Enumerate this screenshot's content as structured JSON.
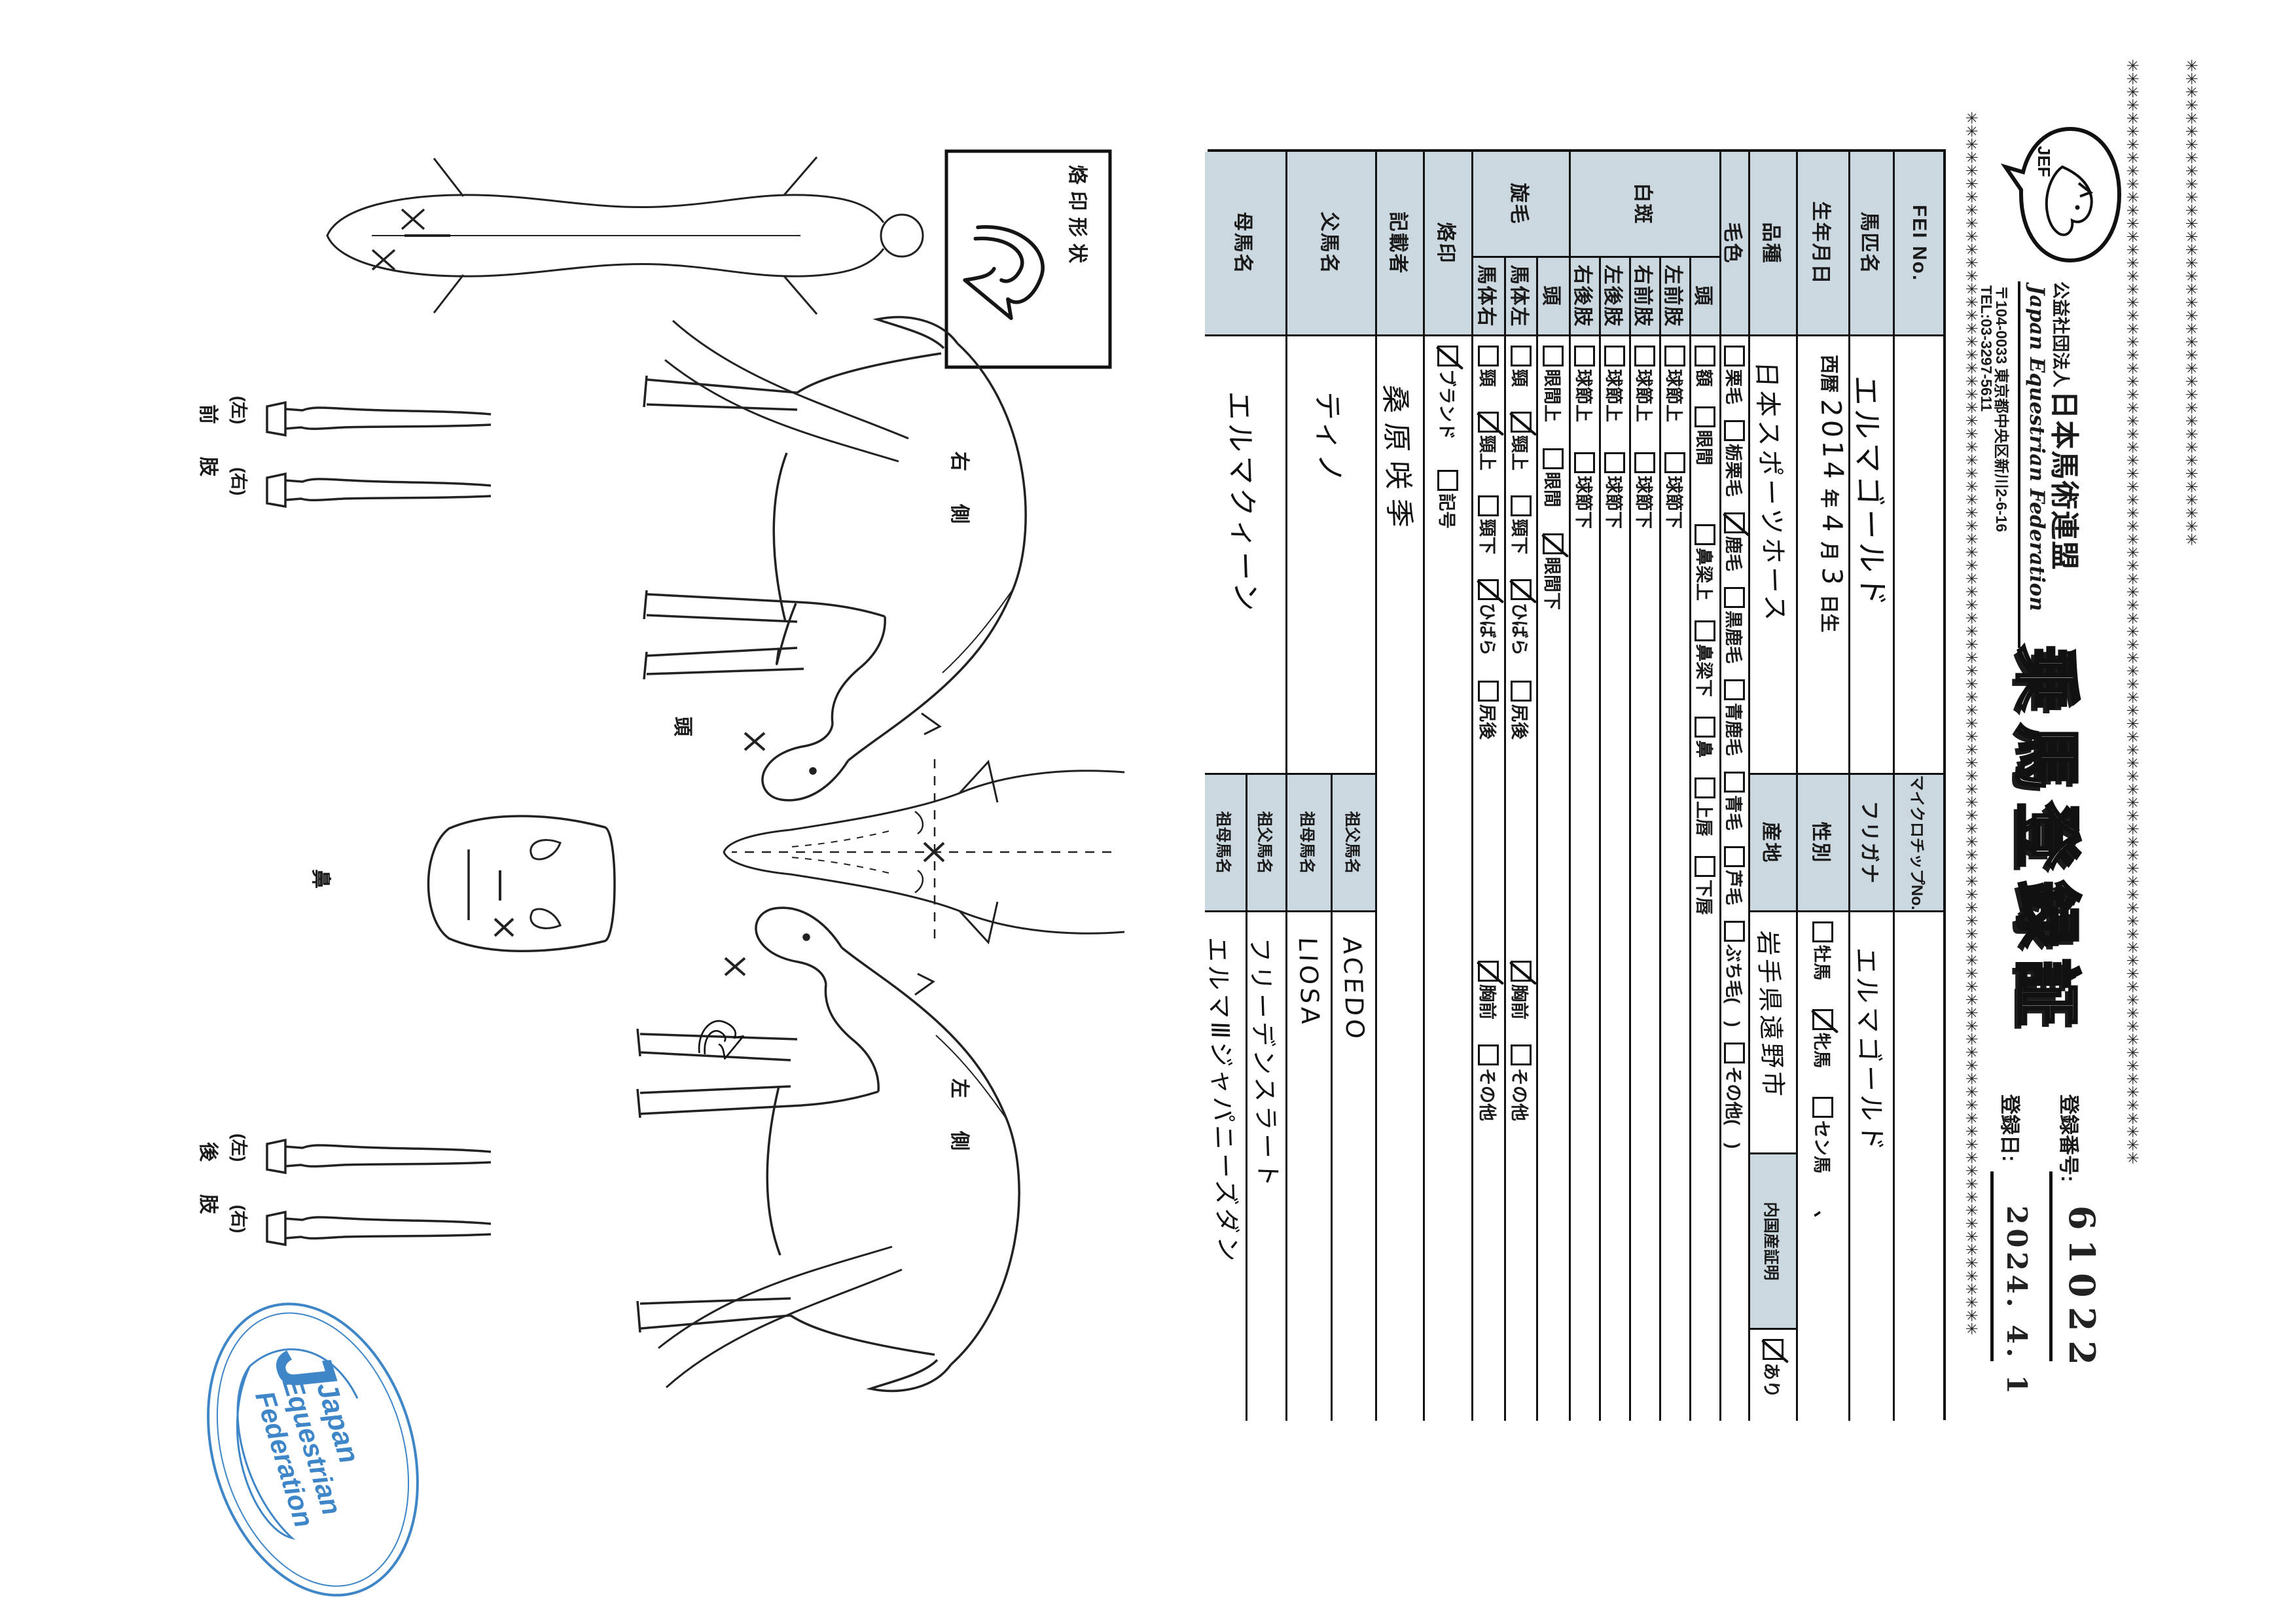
{
  "page": {
    "ink": "#1a1a1a",
    "label_bg": "#ccd8e0",
    "stamp_blue": "#2e7cc3"
  },
  "decoration": {
    "chain_char": "✳"
  },
  "header": {
    "logo_text": "JEF",
    "org_small": "公益社団法人",
    "org_name": "日本馬術連盟",
    "org_en": "Japan Equestrian Federation",
    "address": "〒104-0033 東京都中央区新川2-6-16",
    "tel": "TEL:03-3297-5611",
    "title": "乗馬登録証",
    "reg_no_label": "登録番号:",
    "reg_no": "61022",
    "reg_date_label": "登録日:",
    "reg_date": "2024. 4. 1"
  },
  "table": {
    "row_fei": {
      "label": "FEI No.",
      "value": "",
      "mid": "マイクロチップNo.",
      "value2": ""
    },
    "row_name": {
      "label": "馬匹名",
      "value": "エルマゴールド",
      "mid": "フリガナ",
      "value2": "エルマゴールド"
    },
    "row_birth": {
      "label": "生年月日",
      "era": "西暦",
      "year": "2014",
      "year_sfx": "年",
      "month": "4",
      "month_sfx": "月",
      "day": "3",
      "day_sfx": "日生",
      "mid": "性別",
      "sex_items": [
        {
          "t": "牡馬",
          "c": false
        },
        {
          "t": "牝馬",
          "c": true
        },
        {
          "t": "セン馬",
          "c": false
        }
      ],
      "sex_note": "、"
    },
    "row_breed": {
      "label": "品種",
      "value": "日本スポーツホース",
      "mid": "産地",
      "value2": "岩手県遠野市",
      "cert_label": "内国産証明",
      "cert_items": [
        {
          "t": "あり",
          "c": true
        }
      ]
    },
    "row_coat": {
      "label": "毛色",
      "items": [
        {
          "t": "栗毛",
          "c": false
        },
        {
          "t": "栃栗毛",
          "c": false
        },
        {
          "t": "鹿毛",
          "c": true
        },
        {
          "t": "黒鹿毛",
          "c": false
        },
        {
          "t": "青鹿毛",
          "c": false
        },
        {
          "t": "青毛",
          "c": false
        },
        {
          "t": "芦毛",
          "c": false
        },
        {
          "t": "ぶち毛(　)",
          "c": false
        },
        {
          "t": "その他(　)",
          "c": false
        }
      ]
    },
    "sec_white": {
      "label": "白斑",
      "rows": [
        {
          "label": "頭",
          "items": [
            {
              "t": "額",
              "c": false
            },
            {
              "t": "眼間",
              "c": false
            },
            {
              "t": "鼻梁上",
              "c": false
            },
            {
              "t": "鼻梁下",
              "c": false
            },
            {
              "t": "鼻",
              "c": false
            },
            {
              "t": "上唇",
              "c": false
            },
            {
              "t": "下唇",
              "c": false
            }
          ]
        },
        {
          "label": "左前肢",
          "items": [
            {
              "t": "球節上",
              "c": false
            },
            {
              "t": "球節下",
              "c": false
            }
          ]
        },
        {
          "label": "右前肢",
          "items": [
            {
              "t": "球節上",
              "c": false
            },
            {
              "t": "球節下",
              "c": false
            }
          ]
        },
        {
          "label": "左後肢",
          "items": [
            {
              "t": "球節上",
              "c": false
            },
            {
              "t": "球節下",
              "c": false
            }
          ]
        },
        {
          "label": "右後肢",
          "items": [
            {
              "t": "球節上",
              "c": false
            },
            {
              "t": "球節下",
              "c": false
            }
          ]
        }
      ]
    },
    "sec_whorl": {
      "label": "旋毛",
      "rows": [
        {
          "label": "頭",
          "items": [
            {
              "t": "眼間上",
              "c": false
            },
            {
              "t": "眼間",
              "c": false
            },
            {
              "t": "眼間下",
              "c": true
            }
          ]
        },
        {
          "label": "馬体左",
          "items": [
            {
              "t": "頸",
              "c": false
            },
            {
              "t": "頸上",
              "c": true
            },
            {
              "t": "頸下",
              "c": false
            },
            {
              "t": "ひばら",
              "c": true
            },
            {
              "t": "尻後",
              "c": false
            },
            {
              "t": "胸前",
              "c": true
            },
            {
              "t": "その他",
              "c": false
            }
          ]
        },
        {
          "label": "馬体右",
          "items": [
            {
              "t": "頸",
              "c": false
            },
            {
              "t": "頸上",
              "c": true
            },
            {
              "t": "頸下",
              "c": false
            },
            {
              "t": "ひばら",
              "c": true
            },
            {
              "t": "尻後",
              "c": false
            },
            {
              "t": "胸前",
              "c": true
            },
            {
              "t": "その他",
              "c": false
            }
          ]
        }
      ]
    },
    "row_brand": {
      "label": "烙印",
      "items": [
        {
          "t": "ブランド",
          "c": true
        },
        {
          "t": "記号",
          "c": false
        }
      ]
    },
    "row_writer": {
      "label": "記載者",
      "value": "桑原咲季"
    },
    "row_sire": {
      "label": "父馬名",
      "value": "ティノ",
      "subs": [
        {
          "label": "祖父馬名",
          "value": "ACEDO"
        },
        {
          "label": "祖母馬名",
          "value": "LIOSA"
        }
      ]
    },
    "row_dam": {
      "label": "母馬名",
      "value": "エルマクィーン",
      "subs": [
        {
          "label": "祖父馬名",
          "value": "フリーデンスラート"
        },
        {
          "label": "祖母馬名",
          "value": "エルマⅢジャパニーズダン"
        }
      ]
    }
  },
  "diagram": {
    "brand_box_label": "烙印形状",
    "right_side": "右　側",
    "left_side": "左　側",
    "head_label": "頭",
    "nose_label": "鼻",
    "left_paren": "(左)",
    "right_paren": "(右)",
    "front_limb": "前　肢",
    "hind_limb": "後　肢"
  },
  "stamp": {
    "line1": "Japan",
    "line2": "Equestrian",
    "line3": "Federation",
    "initial": "J"
  }
}
